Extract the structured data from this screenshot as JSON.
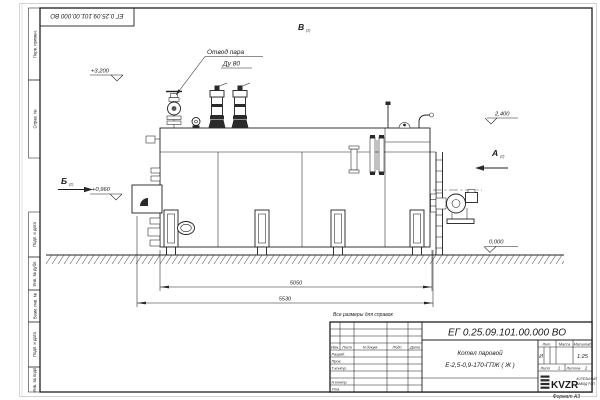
{
  "sheet": {
    "format_label": "Формат А3",
    "reference_note": "Все размеры для справок"
  },
  "margin_labels": {
    "top": [
      "Перв. примен.",
      "Справ. №"
    ],
    "bottom": [
      "Подп. и дата",
      "Инв. № дубл.",
      "Взам. инв. №",
      "Подп. и дата",
      "Инв. № подл."
    ]
  },
  "drawing": {
    "callout": {
      "line1": "Отвод пара",
      "line2": "Ду 80"
    },
    "elevations": {
      "valve_top": "+3,200",
      "boiler_top": "2,400",
      "burner_axis": "+0,960",
      "ground": "0,000"
    },
    "views": {
      "a": "А",
      "b": "Б",
      "v": "В",
      "sheet_ref": "(2)"
    },
    "dimensions": {
      "base_length": "5050",
      "overall_length": "5530"
    }
  },
  "title_block": {
    "doc_number": "ЕГ 0.25.09.101.00.000  ВО",
    "product_line1": "Котел паровой",
    "product_line2": "Е-2,5-0,9-170-ГПЖ ( Ж )",
    "col_izm": "Изм.",
    "col_list": "Лист",
    "col_doc": "N докум.",
    "col_sign": "Подп.",
    "col_date": "Дата",
    "row_razrab": "Разраб.",
    "row_prov": "Пров.",
    "row_tkontr": "Т.контр.",
    "row_nkontr": "Н.контр.",
    "row_utv": "Утв.",
    "lit_header": "Лит.",
    "mass_header": "Масса",
    "scale_header": "Масштаб",
    "lit_value": "И",
    "scale_value": "1:25",
    "sheet_label": "Лист",
    "sheet_value": "1",
    "sheets_label": "Листов",
    "sheets_value": "2",
    "company_logo": "KVZR",
    "company_line1": "КОТЕЛЬНЫЙ",
    "company_line2": "ЗАВОД РЭП"
  }
}
